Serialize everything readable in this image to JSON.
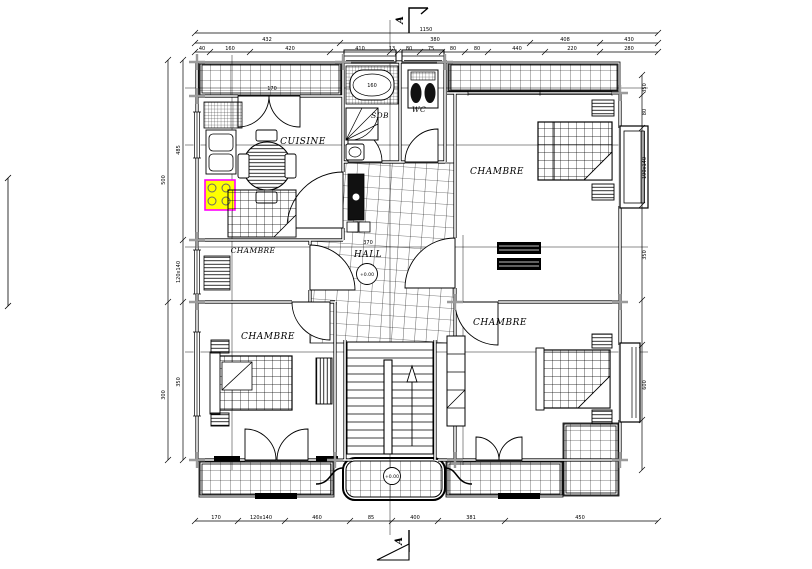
{
  "section_markers": {
    "top": "A",
    "bottom": "A"
  },
  "rooms": {
    "cuisine": "CUISINE",
    "sdb": "SDB",
    "wc": "WC",
    "hall": "HALL",
    "chambre_top_right": "CHAMBRE",
    "chambre_mid_left": "CHAMBRE",
    "chambre_bottom_left": "CHAMBRE",
    "chambre_bottom_right": "CHAMBRE"
  },
  "levels": {
    "hall": "+0.00",
    "entrance": "+0.00"
  },
  "dimensions": {
    "top_total": "1150",
    "top_row1": [
      "432",
      "380",
      "408",
      "430"
    ],
    "top_row2": [
      "40",
      "160",
      "420",
      "410",
      "13",
      "80",
      "75",
      "80",
      "80",
      "440",
      "220",
      "280"
    ],
    "bottom": [
      "170",
      "120x140",
      "460",
      "85",
      "400",
      "381",
      "450"
    ],
    "left_inner": [
      "485",
      "120x140",
      "350"
    ],
    "left_outer": [
      "500",
      "300"
    ],
    "right": [
      "350",
      "80",
      "190x140",
      "350",
      "600"
    ],
    "interior": {
      "bathtub": "160",
      "hall_width": "370",
      "balcony": "170"
    }
  },
  "colors": {
    "line": "#000000",
    "background": "#ffffff",
    "column_marker": "#9b9b9b",
    "stove_fill": "#ffff00",
    "stove_outline": "#ff00ff"
  }
}
